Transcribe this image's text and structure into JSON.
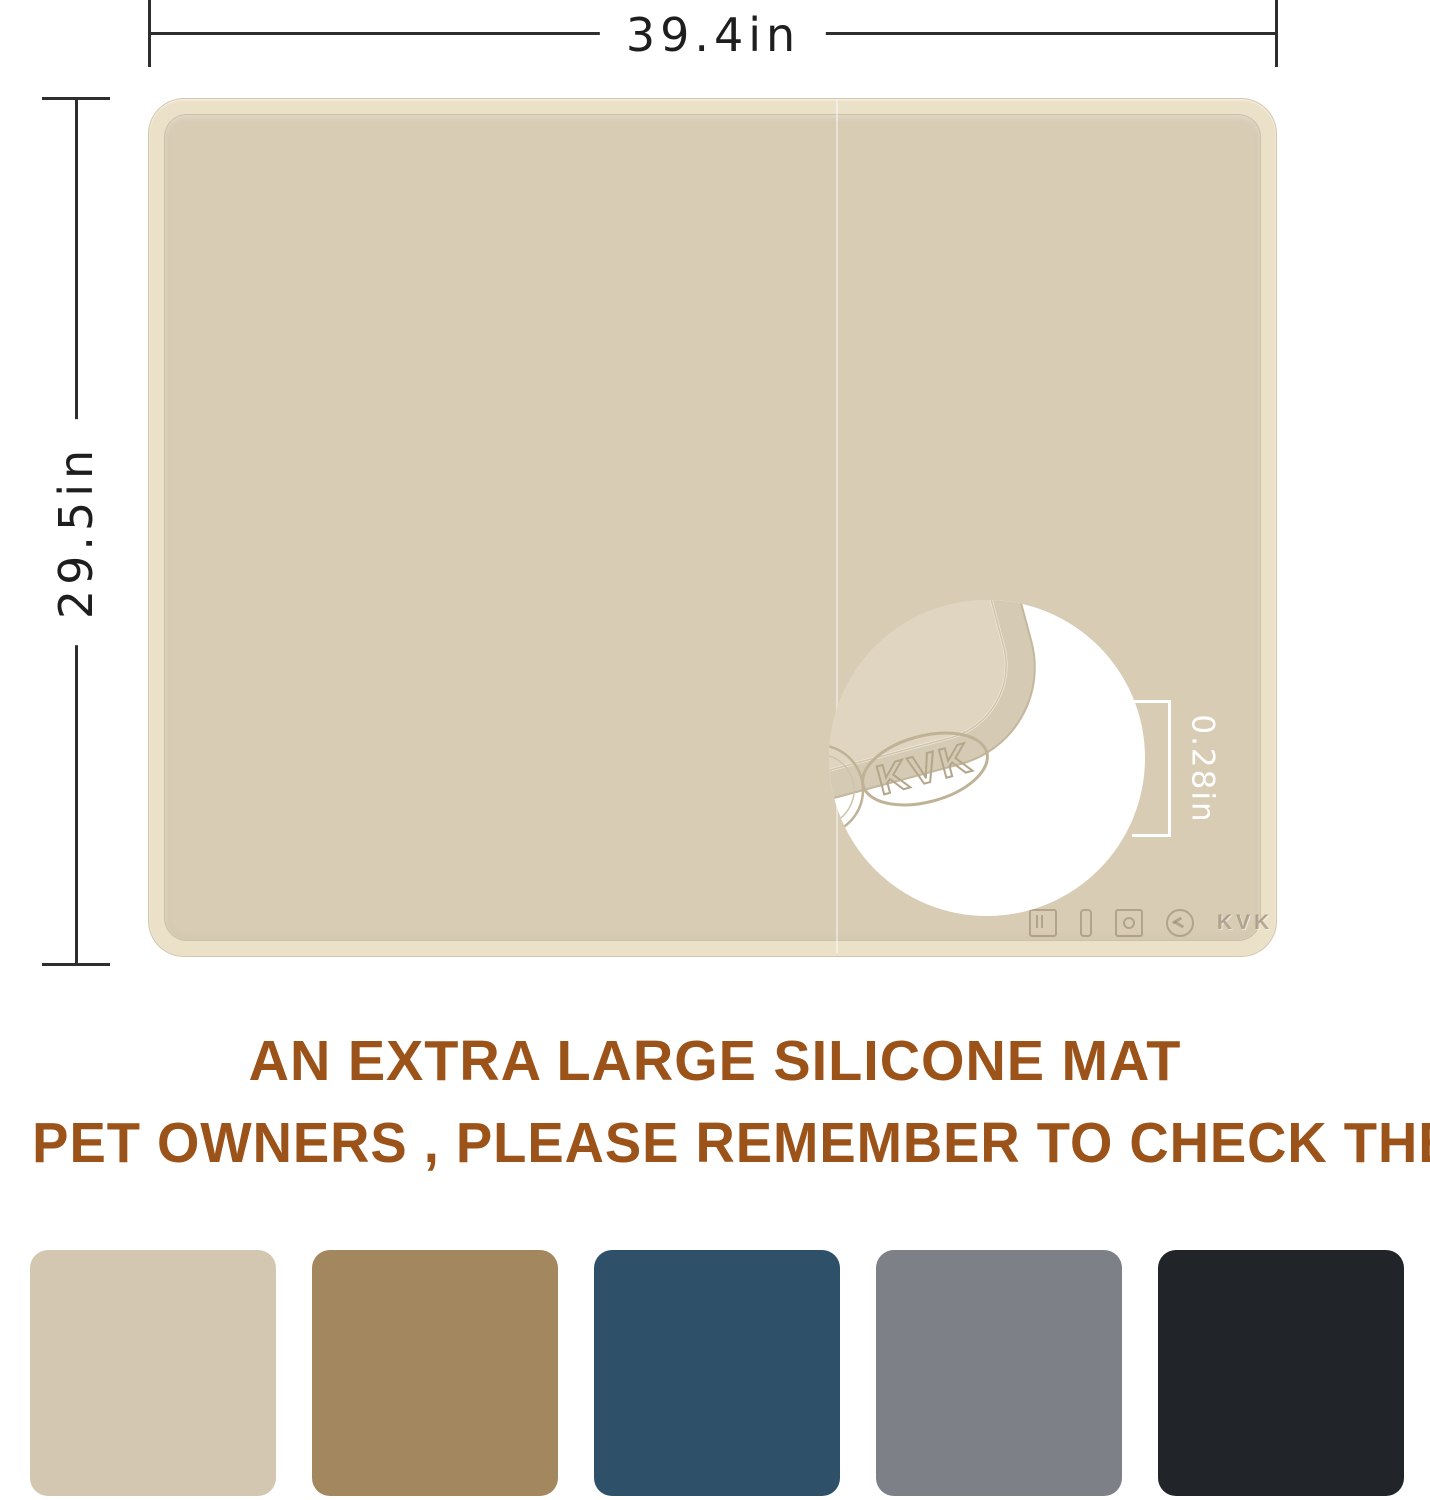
{
  "page": {
    "background": "#ffffff"
  },
  "dimension_annotations": {
    "width": {
      "label": "39.4in"
    },
    "height": {
      "label": "29.5in"
    },
    "thickness": {
      "label": "0.28in",
      "text_color": "#ffffff"
    }
  },
  "mat": {
    "surface_color": "#d8ccb5",
    "rim_color": "#ebe0c8",
    "brand_embossed": "KVK",
    "closeup_brand": "KVK",
    "embossed_icons": [
      {
        "name": "food-grade-icon"
      },
      {
        "name": "temperature-icon"
      },
      {
        "name": "dishwasher-safe-icon"
      },
      {
        "name": "recyclable-icon"
      }
    ]
  },
  "headline": {
    "line1": "AN EXTRA LARGE SILICONE MAT",
    "line2": "PET OWNERS , PLEASE REMEMBER TO CHECK THE SIZE",
    "color": "#9B5319"
  },
  "swatches": [
    {
      "name": "beige",
      "color": "#d3c7b2"
    },
    {
      "name": "camel-brown",
      "color": "#a3875e"
    },
    {
      "name": "steel-blue",
      "color": "#2e5068"
    },
    {
      "name": "slate-gray",
      "color": "#7e8087"
    },
    {
      "name": "black",
      "color": "#212428"
    }
  ]
}
